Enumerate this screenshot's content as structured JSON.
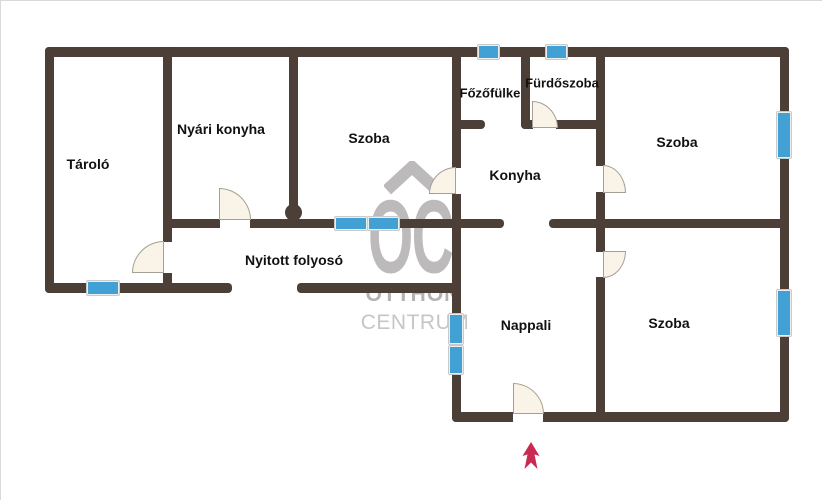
{
  "rooms": {
    "taralo": "Tároló",
    "nyari_konyha": "Nyári konyha",
    "szoba_top_left": "Szoba",
    "fozofulke": "Főzőfülke",
    "furdoszoba": "Fürdőszoba",
    "konyha": "Konyha",
    "szoba_top_right": "Szoba",
    "nyitott_folyoso": "Nyitott folyosó",
    "nappali": "Nappali",
    "szoba_bottom_right": "Szoba"
  },
  "watermark": {
    "logo_text": "OC",
    "line1": "OTTHON",
    "line2": "CENTRUM"
  },
  "markers": {
    "entrance_arrow_direction": "up"
  },
  "colors": {
    "wall": "#4b3f37",
    "window_blue": "#41a1d4",
    "door_fill": "#faf3e8",
    "door_outline": "#a5a096",
    "watermark_gray": "#bcbaba",
    "arrow_red": "#c92a52",
    "label_black": "#111111"
  }
}
